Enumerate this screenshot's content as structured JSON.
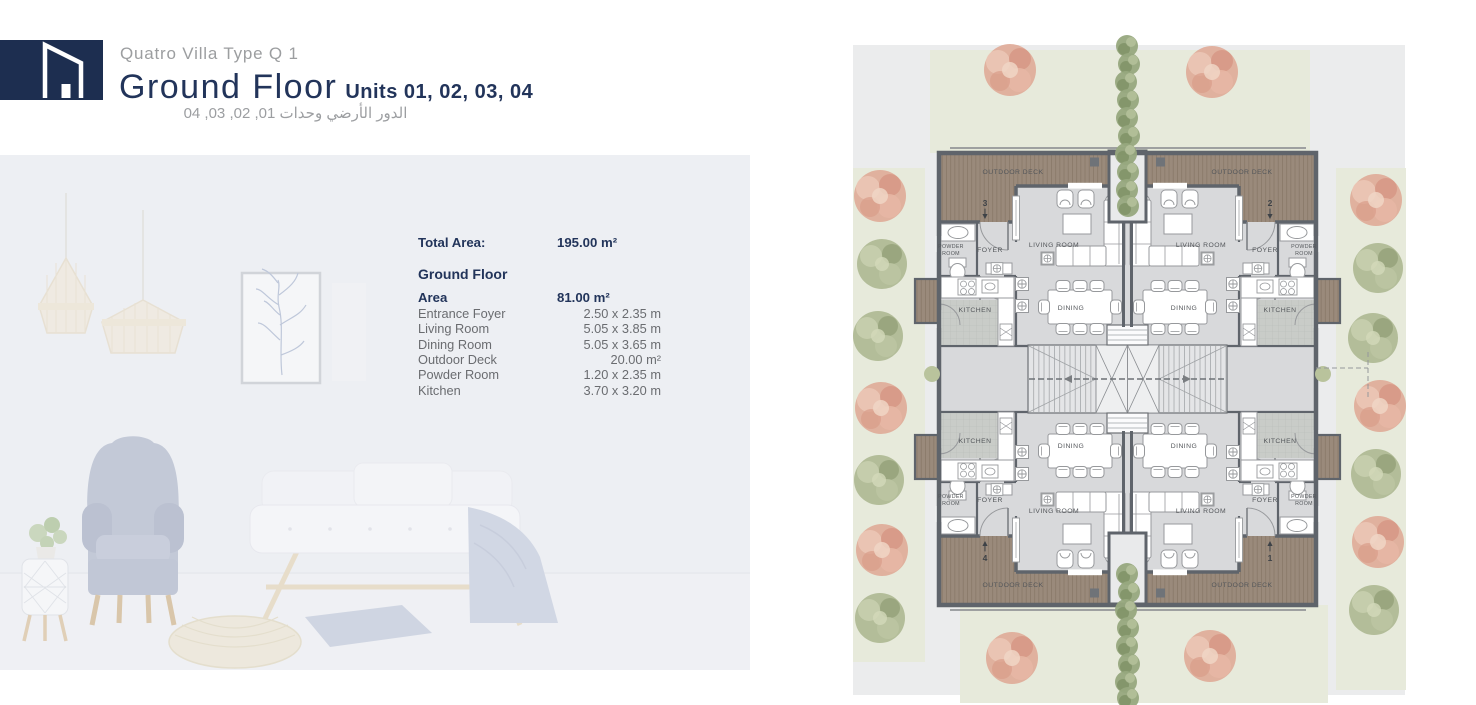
{
  "header": {
    "brand": "Quatro Villa Type Q 1",
    "title": "Ground Floor",
    "units": "Units 01, 02, 03, 04",
    "title_ar": "الدور  الأرضي وحدات 01, 02, 03, 04"
  },
  "area_table": {
    "total_label": "Total Area:",
    "total_value": "195.00 m²",
    "floor_heading": "Ground Floor",
    "area_label": "Area",
    "area_value": "81.00 m²",
    "rows": [
      {
        "label": "Entrance Foyer",
        "value": "2.50 x 2.35 m"
      },
      {
        "label": "Living Room",
        "value": "5.05 x 3.85 m"
      },
      {
        "label": "Dining Room",
        "value": "5.05 x 3.65 m"
      },
      {
        "label": "Outdoor Deck",
        "value": "20.00 m²"
      },
      {
        "label": "Powder Room",
        "value": "1.20 x 2.35 m"
      },
      {
        "label": "Kitchen",
        "value": "3.70 x 3.20 m"
      }
    ]
  },
  "plan": {
    "labels": {
      "outdoor_deck": "OUTDOOR DECK",
      "living_room": "LIVING ROOM",
      "foyer": "FOYER",
      "powder1": "POWDER",
      "powder2": "ROOM",
      "kitchen": "KITCHEN",
      "dining": "DINING"
    },
    "units": {
      "tl": "3",
      "tr": "2",
      "bl": "4",
      "br": "1"
    }
  },
  "colors": {
    "navy": "#22345A",
    "logo_navy": "#1D2E50",
    "text_gray": "#9C9EA0",
    "panel_bg": "#EDEFF3",
    "deck_brown": "#9A8A7B",
    "wall_gray": "#5F646B",
    "floor_gray": "#D8D9DB",
    "landscape_green": "#E7EADB",
    "tree_pink": "#DFA895",
    "tree_green": "#A9B58D"
  }
}
